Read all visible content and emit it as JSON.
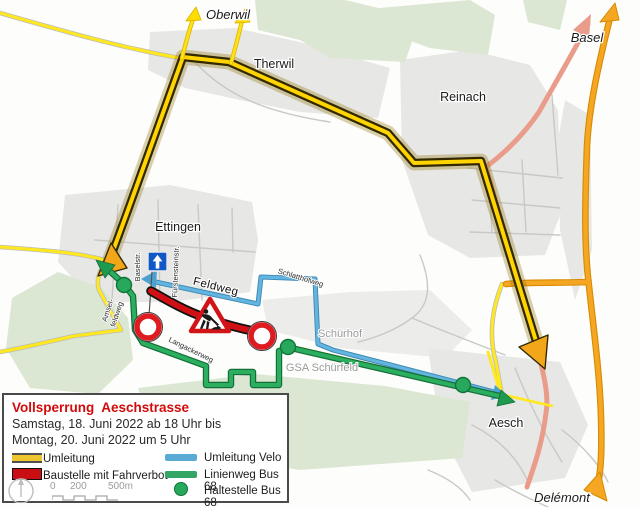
{
  "legend": {
    "title": "Vollsperrung  Aeschstrasse",
    "date_line1": "Samstag, 18. Juni 2022 ab 18 Uhr bis",
    "date_line2": "Montag, 20. Juni 2022 um 5 Uhr",
    "items": {
      "umleitung": "Umleitung",
      "baustelle": "Baustelle mit Fahrverbot",
      "velo": "Umleitung Velo",
      "bus": "Linienweg Bus 68",
      "haltestelle": "Haltestelle Bus 68"
    },
    "scale_ticks": [
      "0",
      "200",
      "500m"
    ]
  },
  "map": {
    "towns": {
      "oberwil": "Oberwil",
      "therwil": "Therwil",
      "reinach": "Reinach",
      "basel": "Basel",
      "ettingen": "Ettingen",
      "aesch": "Aesch",
      "delemont": "Delémont"
    },
    "places": {
      "schuerhof": "Schürhof",
      "gsa": "GSA Schürfeld"
    },
    "streets": {
      "feldweg": "Feldweg",
      "schlatthofweg": "Schlatthofweg",
      "langackerweg": "Langackerweg",
      "baselstr": "Baselstr.",
      "fuerstensteinstr": "Fürstensteinstr.",
      "amsel_line1": "Amsel-",
      "amsel_line2": "feldweg"
    }
  },
  "icons": {
    "one_way_sign": "blue square, white up arrow",
    "construction_sign": "red triangle, worker digging",
    "no_entry_sign": "white disc, red ring",
    "bus_stop": "green dot",
    "compass": "north circle"
  },
  "colors": {
    "umleitung_yellow": "#FFD400",
    "umleitung_casing": "#332900",
    "arrowhead_orange": "#F2A71B",
    "regional_route_orange": "#F5A623",
    "velo_blue": "#63B4DF",
    "bus_green": "#2CAE5F",
    "baustelle_red": "#D01015",
    "alt_route_pink": "#EA9C8B",
    "minor_road_yellow": "#FFE81E",
    "settlement_gray": "#e7e7e5",
    "forest_green": "#dbe6d3"
  }
}
